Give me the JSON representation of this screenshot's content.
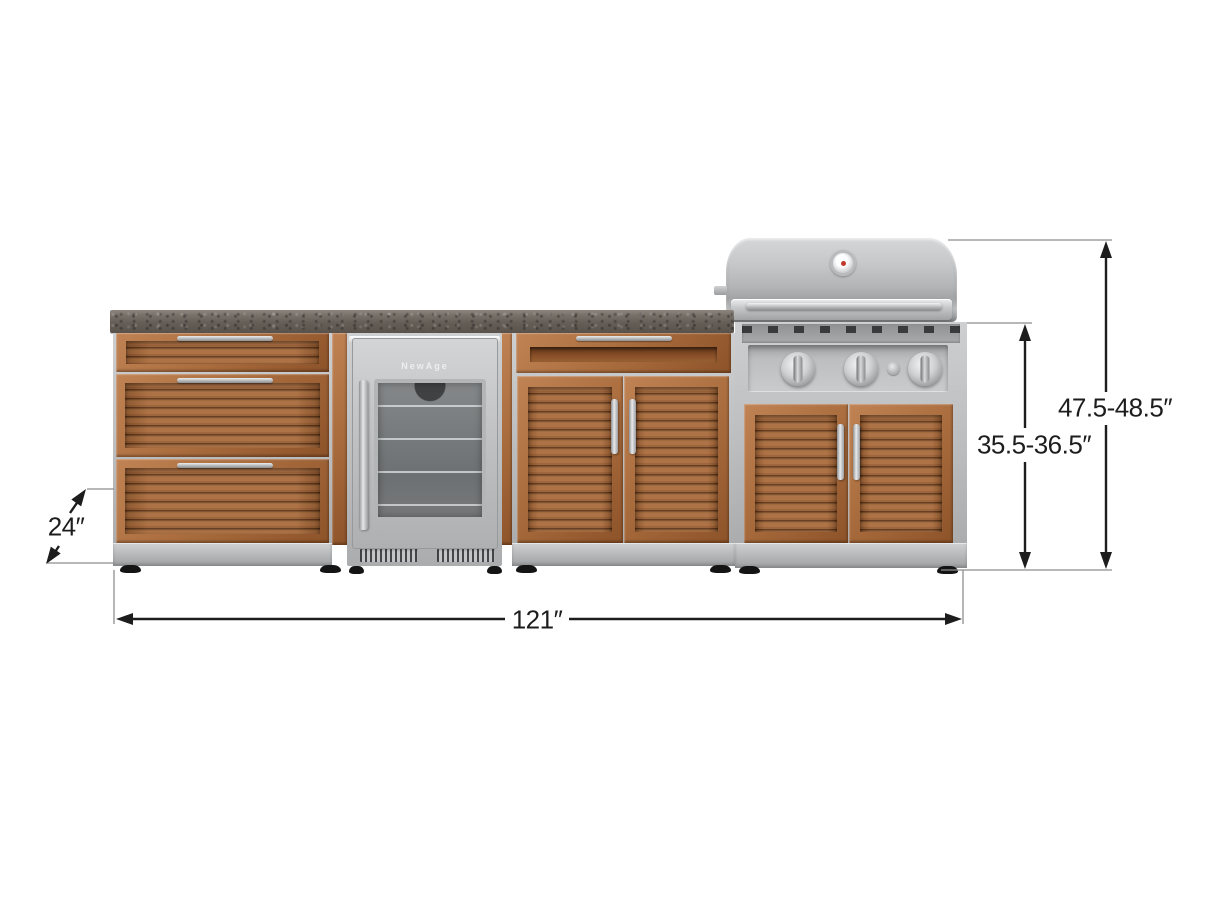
{
  "diagram": {
    "type": "product dimension diagram",
    "subject": "Outdoor kitchen cabinet set: 3-drawer cabinet, glass-door refrigerator, 2-door cabinet and grill cabinet with stainless grill on a shared countertop"
  },
  "dimensions": {
    "depth_label": "24″",
    "width_label": "121″",
    "counter_height_label": "35.5-36.5″",
    "overall_height_label": "47.5-48.5″"
  },
  "appliances": {
    "fridge_brand": "NewAge"
  },
  "colors": {
    "wood": "#a4683a",
    "stainless": "#c4c6c8",
    "countertop": "#6a635c",
    "dimension_line": "#1d1d1d",
    "extension_line": "#8e8e8e",
    "background": "#ffffff"
  }
}
